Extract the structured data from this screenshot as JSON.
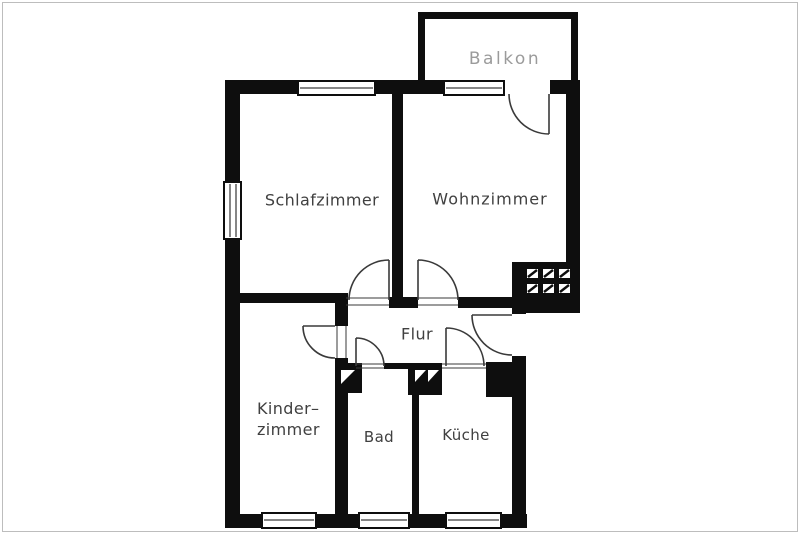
{
  "plan": {
    "type": "apartment-floor-plan",
    "rooms": {
      "balkon": {
        "label": "Balkon"
      },
      "schlafzimmer": {
        "label": "Schlafzimmer"
      },
      "wohnzimmer": {
        "label": "Wohnzimmer"
      },
      "flur": {
        "label": "Flur"
      },
      "kinderzimmer": {
        "label_line1": "Kinder–",
        "label_line2": "zimmer"
      },
      "bad": {
        "label": "Bad"
      },
      "kueche": {
        "label": "Küche"
      }
    }
  },
  "colors": {
    "wall": "#0e0e0e",
    "door": "#3a3a3a",
    "label": "#404040",
    "balkon_label": "#9b9b9b",
    "background": "#ffffff"
  }
}
